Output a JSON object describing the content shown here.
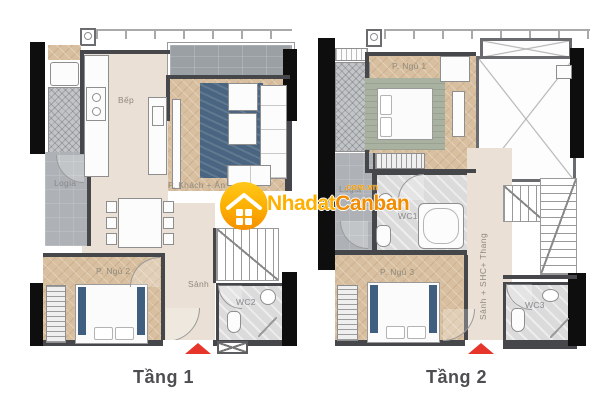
{
  "watermark": {
    "brand_part1": "Nhadat",
    "brand_part2": "Canban",
    "domain": ".com.vn"
  },
  "floor1": {
    "caption": "Tầng 1",
    "labels": {
      "kitchen": "Bếp",
      "living": "P. Khách + Ăn",
      "logia": "Logia",
      "bedroom2": "P. Ngủ 2",
      "hall": "Sảnh",
      "wc2": "WC2"
    }
  },
  "floor2": {
    "caption": "Tầng 2",
    "labels": {
      "bedroom1": "P. Ngủ 1",
      "wc1": "WC1",
      "logia": "Logia",
      "hall_vertical": "Sảnh + SHC+ Thang",
      "bedroom3": "P. Ngủ 3",
      "wc3": "WC3"
    }
  },
  "colors": {
    "wood_floor": "#d8bf9f",
    "beige_floor": "#eae0d5",
    "balcony_tile": "#9ba0a5",
    "wc_marble": "#dbdbdb",
    "wall": "#46474b",
    "black_wall": "#0e0e0e",
    "rug_blue": "#4a6581",
    "rug_sage": "#a9b1a0",
    "entry_arrow": "#e6352b",
    "brand_yellow": "#ffb000",
    "brand_orange": "#f28c00"
  }
}
